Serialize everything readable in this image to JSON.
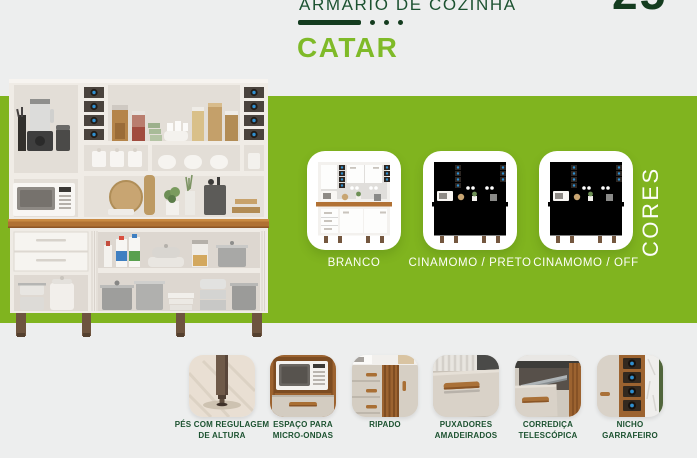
{
  "page": {
    "number": "25",
    "colors": {
      "background": "#edeeee",
      "band": "#80b41f",
      "dark_green": "#1c5230",
      "darker_green": "#143c1f",
      "bright_green": "#7fba28",
      "label_white": "#fdfef9",
      "wood": "#b17134",
      "bottle_blue": "#2f8fd0"
    }
  },
  "header": {
    "category_title": "ARMÁRIO DE COZINHA",
    "product_name": "CATAR"
  },
  "hero": {
    "description": "armario-de-cozinha-catar-branco-photo"
  },
  "cores": {
    "title": "CORES",
    "variants": [
      {
        "label": "BRANCO",
        "frame": "#f3f1ee",
        "door": "#fdfdfc",
        "handle": "#c9c4bd",
        "counter": "#b17134"
      },
      {
        "label": "CINAMOMO / PRETO",
        "frame": "#ab6532",
        "door": "#29231f",
        "handle": "#b17134",
        "counter": "#8a4f26"
      },
      {
        "label": "CINAMOMO / OFF",
        "frame": "#ab6532",
        "door": "#ded6ca",
        "handle": "#b17134",
        "counter": "#8a4f26"
      }
    ]
  },
  "features": [
    {
      "icon": "adjustable-feet-photo",
      "label": "PÉS COM REGULAGEM\nDE ALTURA"
    },
    {
      "icon": "microwave-space-photo",
      "label": "ESPAÇO PARA\nMICRO-ONDAS"
    },
    {
      "icon": "slatted-panel-photo",
      "label": "RIPADO"
    },
    {
      "icon": "wooden-handles-photo",
      "label": "PUXADORES\nAMADEIRADOS"
    },
    {
      "icon": "telescopic-slide-photo",
      "label": "CORREDIÇA\nTELESCÓPICA"
    },
    {
      "icon": "bottle-rack-photo",
      "label": "NICHO\nGARRAFEIRO"
    }
  ]
}
